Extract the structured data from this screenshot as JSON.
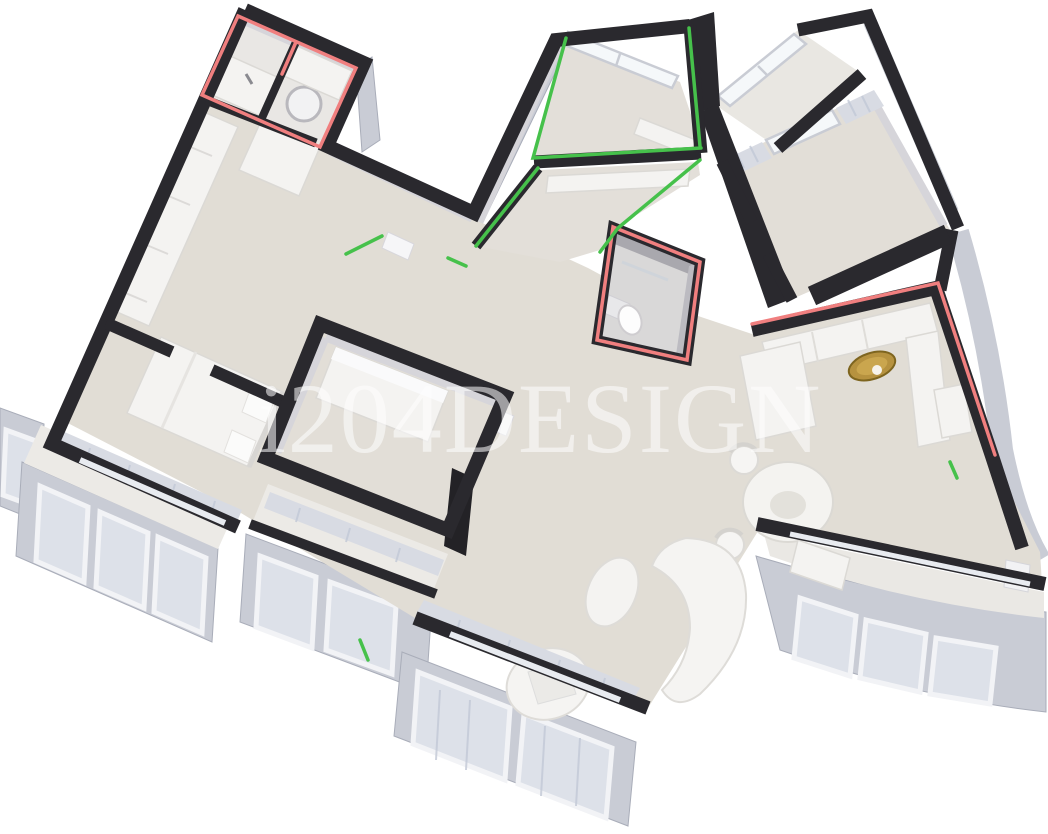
{
  "image": {
    "kind": "3D axonometric cutaway render of an apartment floor plan",
    "background": "#ffffff"
  },
  "watermark": {
    "text": "i204DESIGN"
  },
  "palette": {
    "wall": "#2a292e",
    "floor": "#e1ddd5",
    "floor_light": "#eceae6",
    "facade": "#c9ccd5",
    "curtain": "#d8dbe3",
    "furn": "#f4f3f1",
    "red": "#f07f7f",
    "green": "#46c14b",
    "gold": "#b6923f"
  },
  "rooms": [
    {
      "name": "bathroom-top-left",
      "highlight": "red",
      "contents": [
        "sink-counter",
        "round-basin",
        "partition"
      ]
    },
    {
      "name": "hallway-left-wing",
      "highlight": "none",
      "contents": [
        "wardrobe",
        "cabinet"
      ]
    },
    {
      "name": "bedroom-left",
      "highlight": "none",
      "contents": [
        "bed",
        "pillows",
        "curtains",
        "glazed-balcony"
      ]
    },
    {
      "name": "walk-in-closet-center",
      "highlight": "none",
      "contents": [
        "wardrobe",
        "door",
        "tv-panel",
        "balcony"
      ]
    },
    {
      "name": "laundry-hall-top-center",
      "highlight": "green",
      "contents": [
        "window",
        "counter"
      ]
    },
    {
      "name": "inner-hall-center",
      "highlight": "green",
      "contents": [
        "wardrobe-strip"
      ]
    },
    {
      "name": "bathroom-center",
      "highlight": "red",
      "contents": [
        "toilet",
        "shower-glass",
        "cistern"
      ]
    },
    {
      "name": "loggia-top-right",
      "highlight": "none",
      "contents": [
        "window"
      ]
    },
    {
      "name": "bedroom-top-right",
      "highlight": "none",
      "contents": [
        "curtains",
        "window"
      ]
    },
    {
      "name": "kitchen-right",
      "highlight": "red",
      "contents": [
        "l-counter",
        "gold-sink",
        "tall-cabinet",
        "appliance-block"
      ]
    },
    {
      "name": "dining-area",
      "highlight": "none",
      "contents": [
        "round-table",
        "chair",
        "chair"
      ]
    },
    {
      "name": "living-room-bottom",
      "highlight": "none",
      "contents": [
        "curved-sofa",
        "oval-pouf",
        "armchair",
        "curtains"
      ]
    },
    {
      "name": "curved-balcony-bottom-right",
      "highlight": "none",
      "contents": [
        "desk",
        "radiator",
        "windows"
      ]
    }
  ]
}
